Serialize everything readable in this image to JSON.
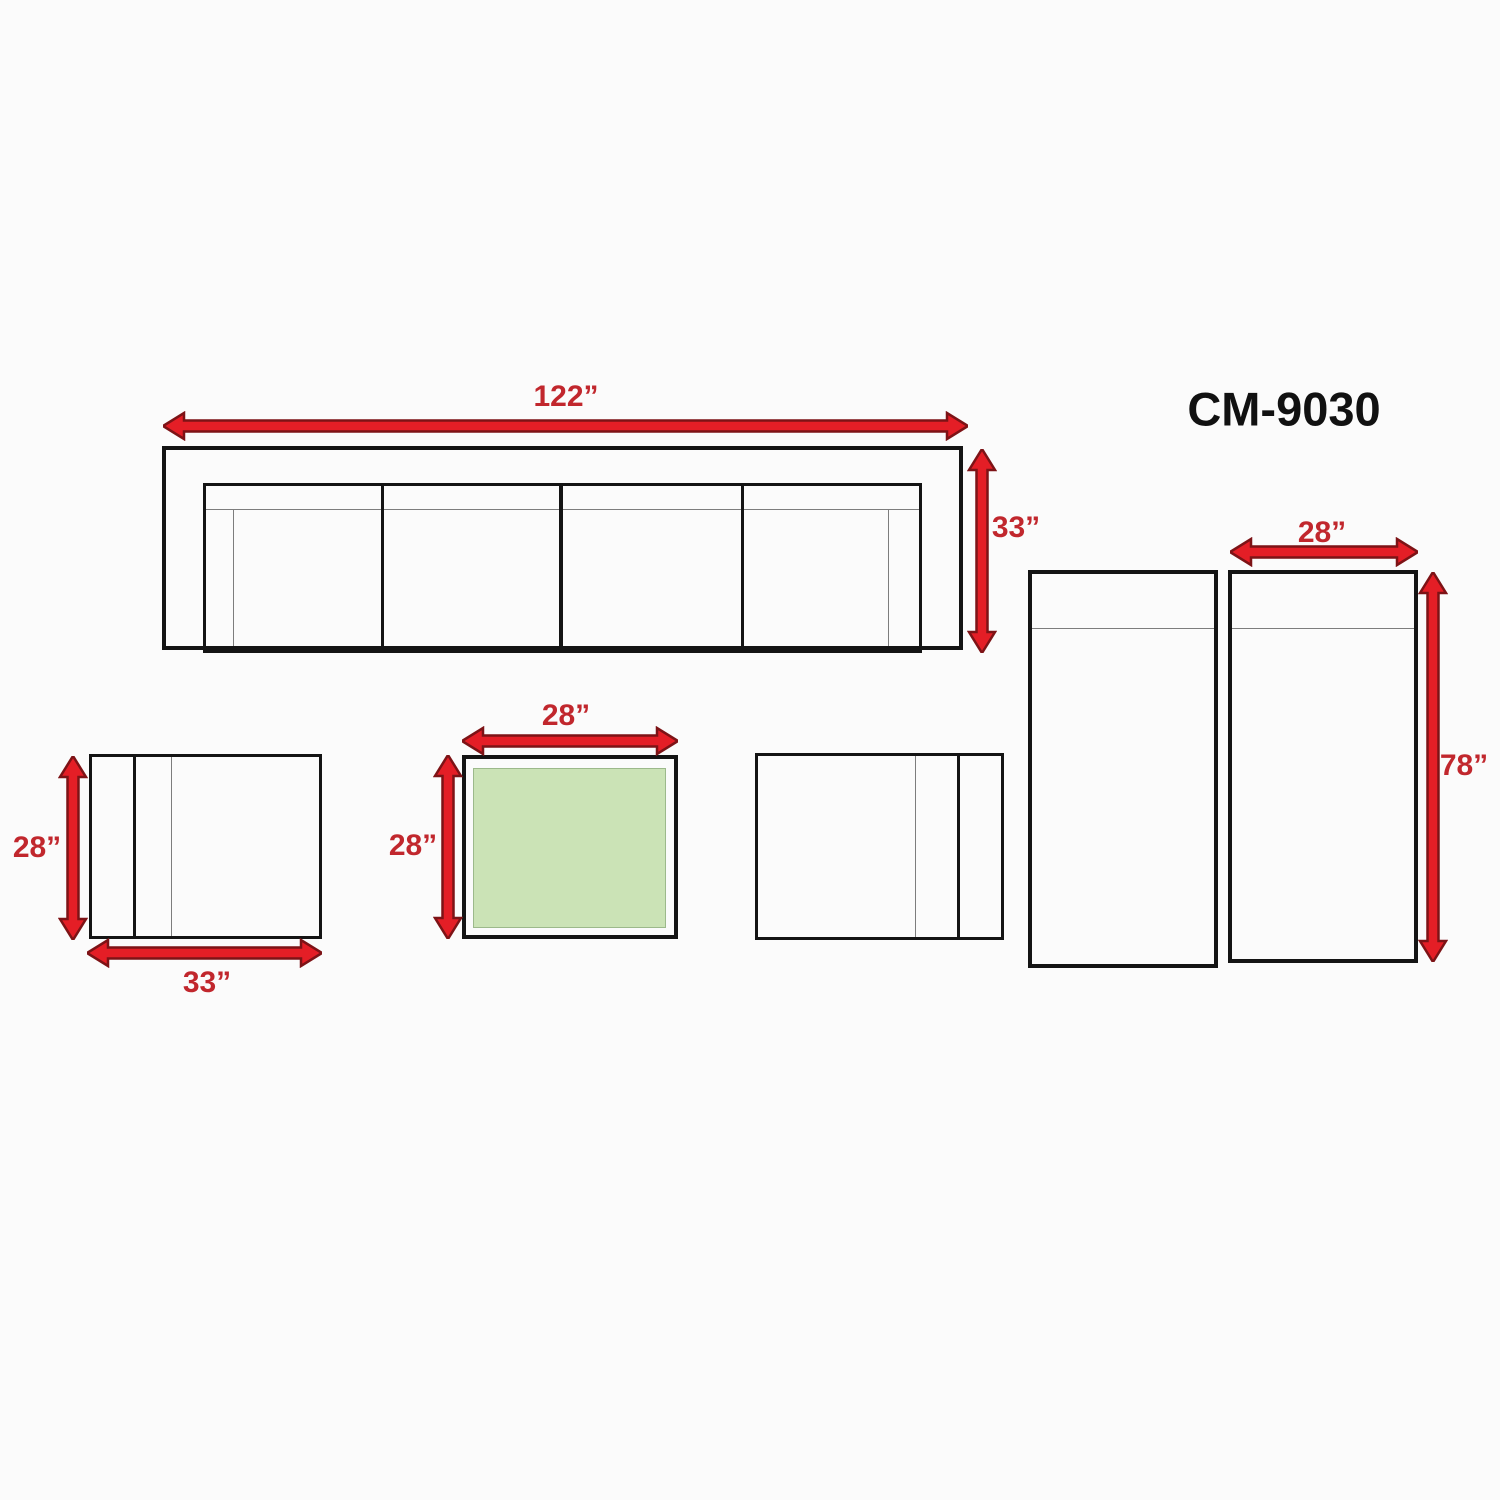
{
  "title": "CM-9030",
  "labels": {
    "sofa_width": "122”",
    "sofa_depth": "33”",
    "lounge_width": "28”",
    "lounge_length": "78”",
    "chair_depth": "28”",
    "chair_width": "33”",
    "table_width": "28”",
    "table_depth": "28”"
  },
  "colors": {
    "arrow_fill": "#e41e26",
    "arrow_outline": "#7d1316",
    "dimension_text": "#c1272d",
    "line_black": "#141414",
    "line_gray": "#7d7d7d",
    "table_top_green": "#cbe3b6",
    "background": "#fbfbfb"
  }
}
